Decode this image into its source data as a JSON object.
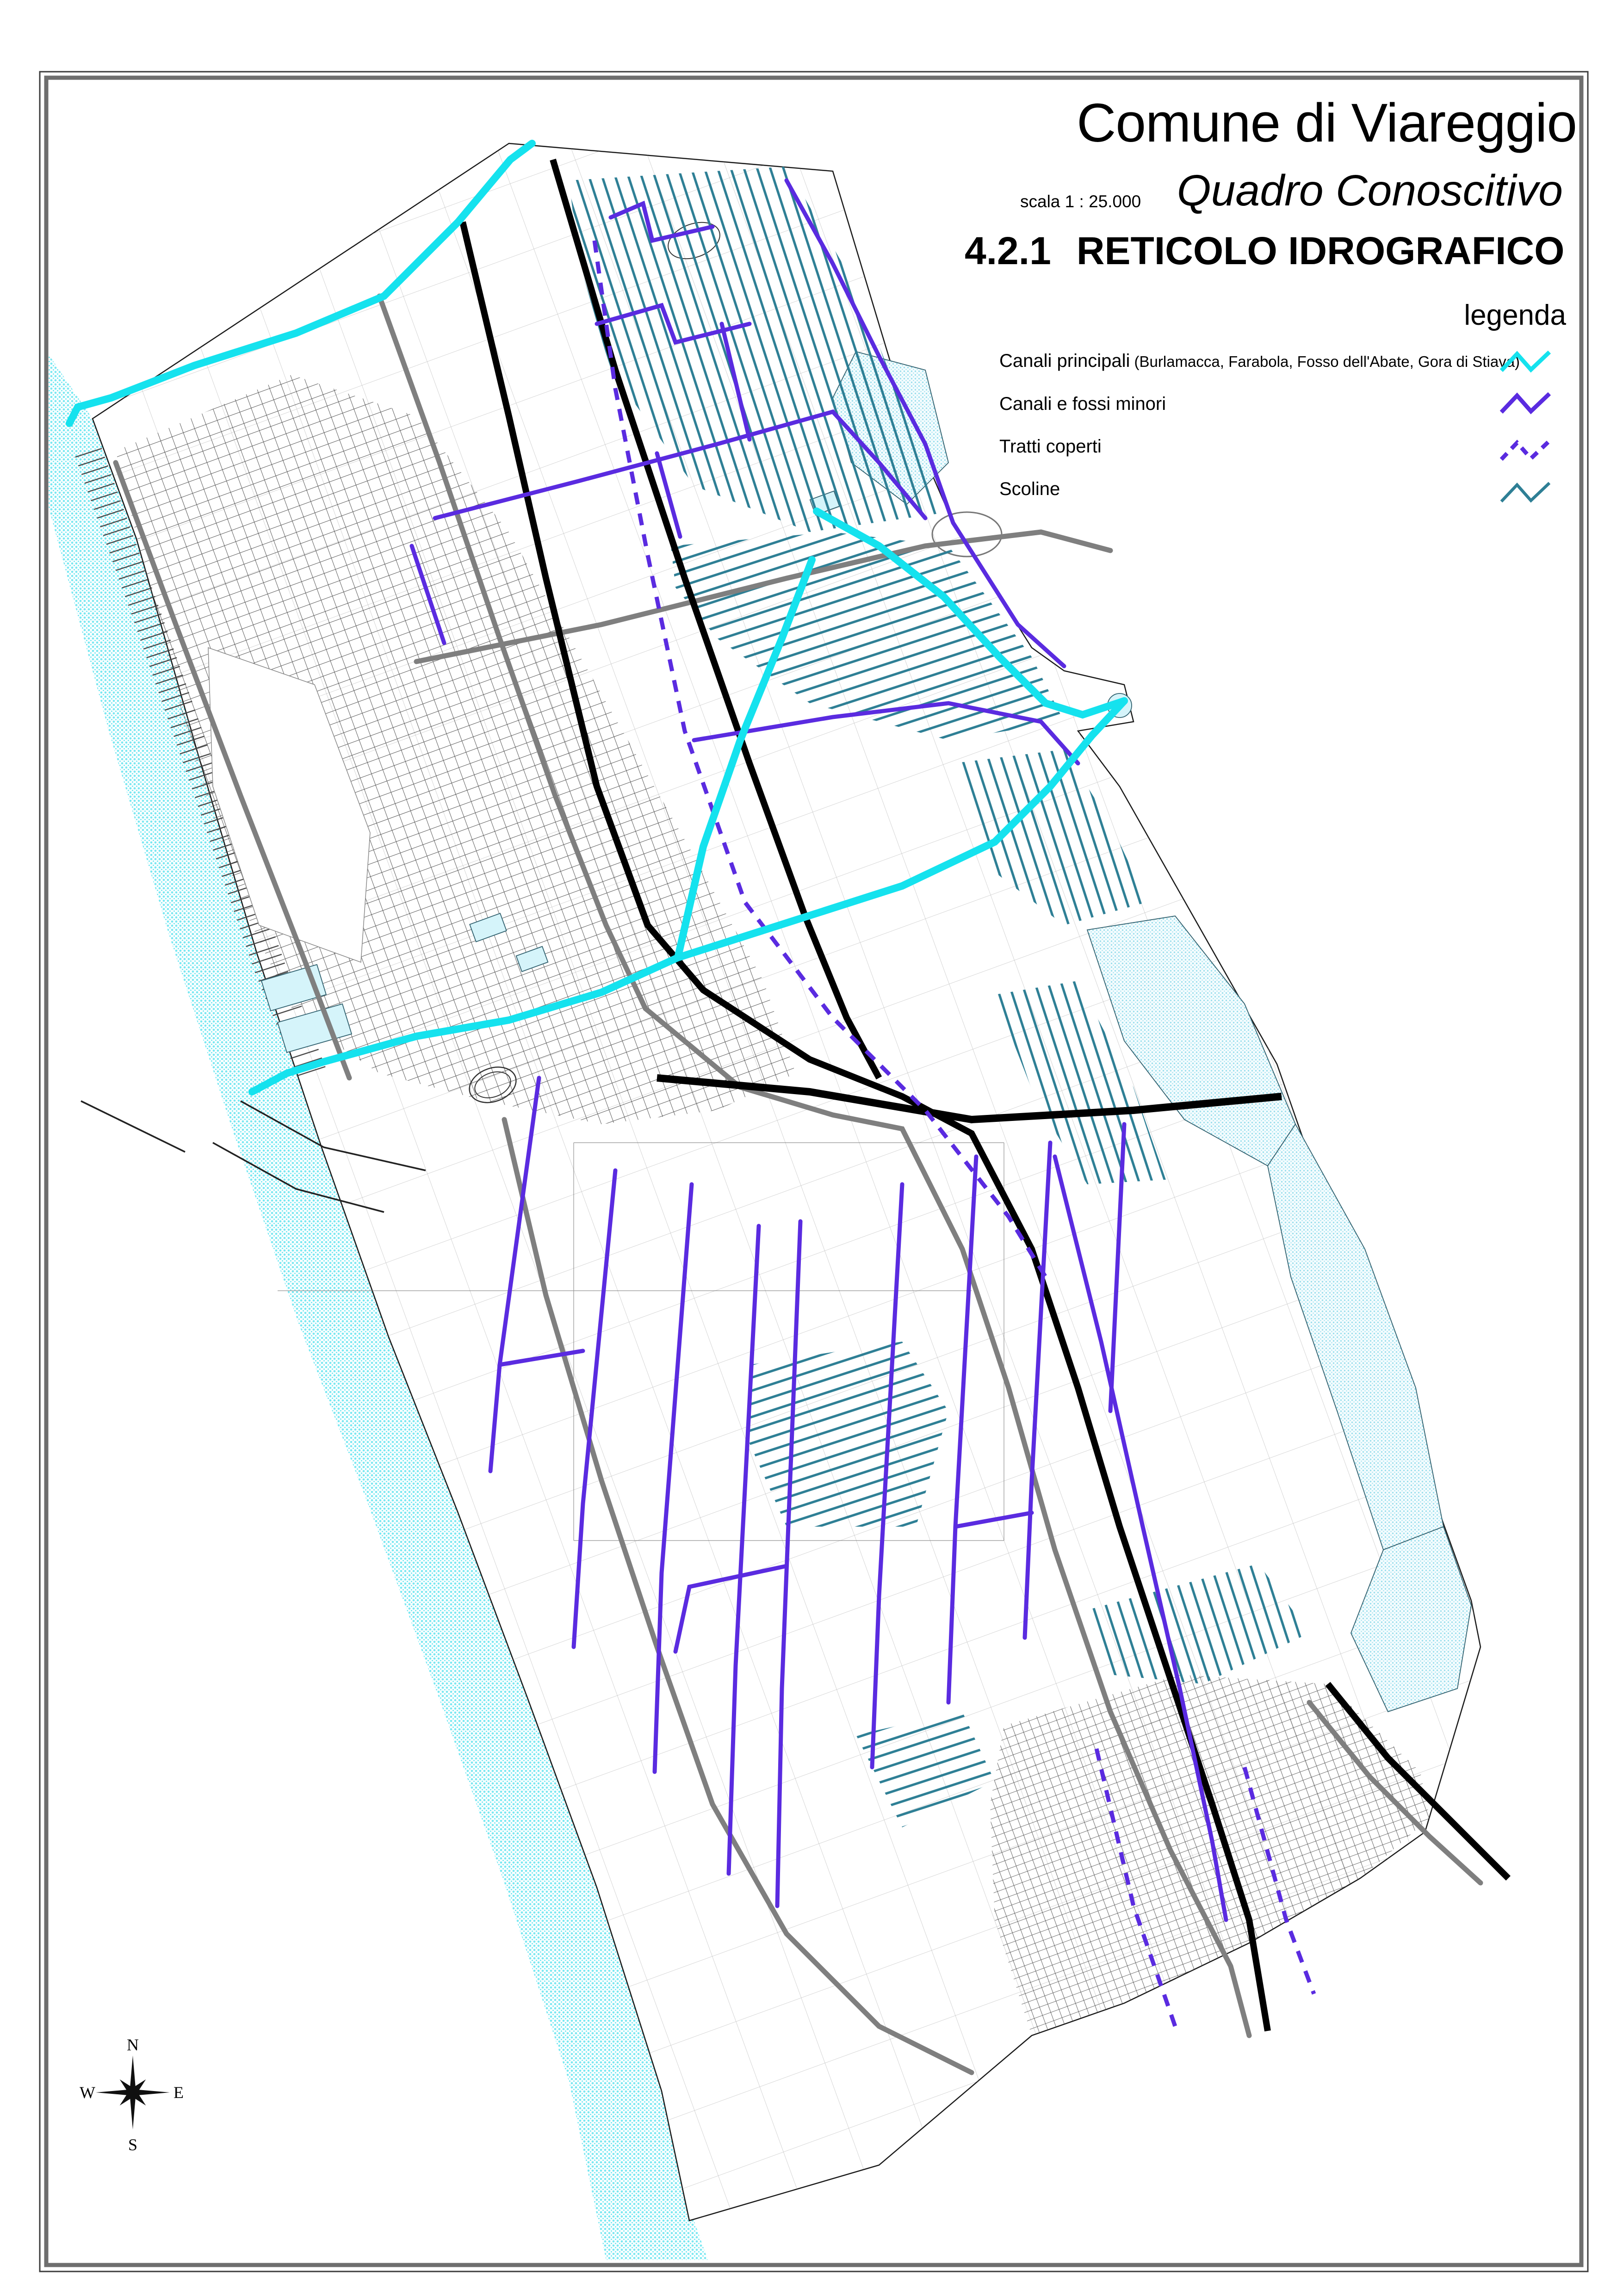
{
  "document": {
    "municipality": "Comune di Viareggio",
    "scale_label": "scala 1 : 25.000",
    "subtitle": "Quadro Conoscitivo",
    "sheet_number": "4.2.1",
    "sheet_title": "RETICOLO IDROGRAFICO"
  },
  "legend": {
    "heading": "legenda",
    "items": [
      {
        "label": "Canali principali",
        "note": " (Burlamacca, Farabola, Fosso dell'Abate, Gora di Stiava)",
        "style": "solid"
      },
      {
        "label": "Canali e fossi minori",
        "note": "",
        "style": "solid"
      },
      {
        "label": "Tratti coperti",
        "note": "",
        "style": "dashed"
      },
      {
        "label": "Scoline",
        "note": "",
        "style": "solid"
      }
    ]
  },
  "compass": {
    "n": "N",
    "e": "E",
    "s": "S",
    "w": "W"
  },
  "palette": {
    "canali_principali": "#15e2ee",
    "canali_minori": "#5a2be0",
    "tratti_coperti": "#5a2be0",
    "scoline": "#2e7f95",
    "sea_dots": "#7ae8f2",
    "marsh_dots": "#9adeed",
    "road_primary": "#000000",
    "road_secondary": "#7f7f7f",
    "urban_fabric": "#3f3f3f",
    "field_parcels": "#8a8a8a",
    "frame_outer": "#3c3c3c",
    "frame_inner": "#6e6e6e"
  }
}
